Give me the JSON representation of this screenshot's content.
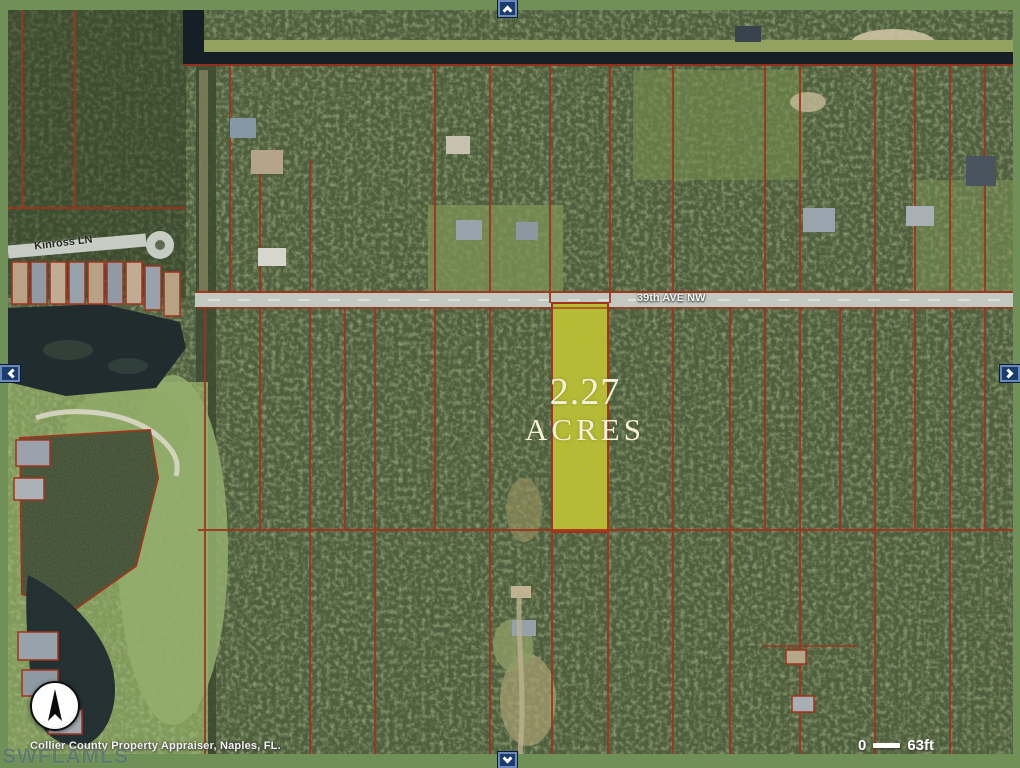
{
  "map": {
    "highlight": {
      "acreage": "2.27",
      "unit": "ACRES"
    },
    "streets": [
      {
        "name": "Kinross LN"
      },
      {
        "name": "39th AVE NW"
      }
    ],
    "scalebar": {
      "start": "0",
      "end": "63ft"
    },
    "attribution": "Collier County Property Appraiser, Naples, FL.",
    "watermark": "SWFLAMLS",
    "nav": {
      "up": "pan up",
      "down": "pan down",
      "left": "pan left",
      "right": "pan right"
    },
    "compass": "north"
  },
  "colors": {
    "frame_green": "#6f9158",
    "parcel_highlight_yellow": "#b9be2e",
    "boundary_red": "#a3321c",
    "nav_button_navy": "#1b3c70",
    "label_cream": "#f5f0d8",
    "canal_dark": "#161f26",
    "road_gray": "#c3c9c1"
  }
}
